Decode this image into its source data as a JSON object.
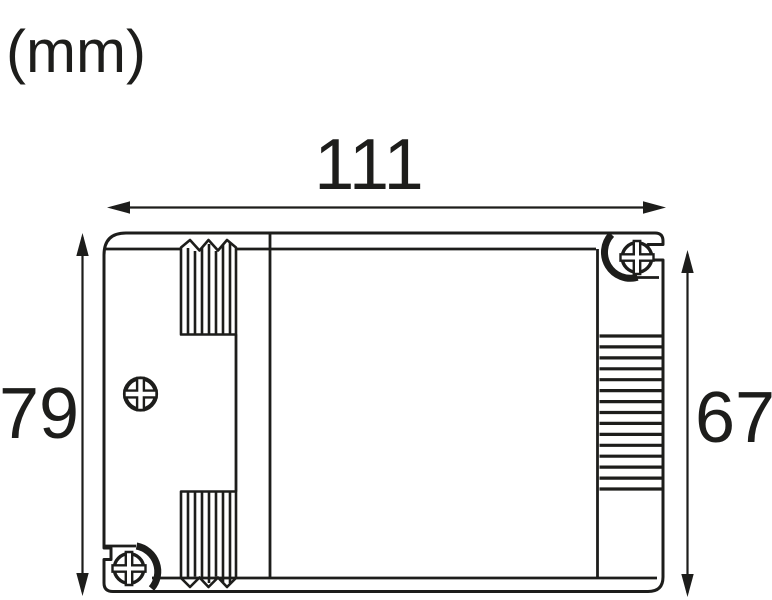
{
  "unit_label": "(mm)",
  "dimensions": {
    "width_mm": "111",
    "height_overall_mm": "79",
    "height_body_mm": "67"
  },
  "colors": {
    "line": "#1d1d1b",
    "background": "#ffffff"
  },
  "icons": {
    "screw_center_left": "phillips-screw-icon",
    "screw_top_right": "phillips-screw-icon",
    "screw_bottom_left": "phillips-screw-icon",
    "width_arrow": "horizontal-double-arrow-icon",
    "height_left_arrow": "vertical-double-arrow-icon",
    "height_right_arrow": "vertical-double-arrow-icon",
    "top_vent": "vent-fins-icon",
    "bottom_vent": "vent-fins-icon",
    "side_vent": "vent-fins-icon"
  }
}
